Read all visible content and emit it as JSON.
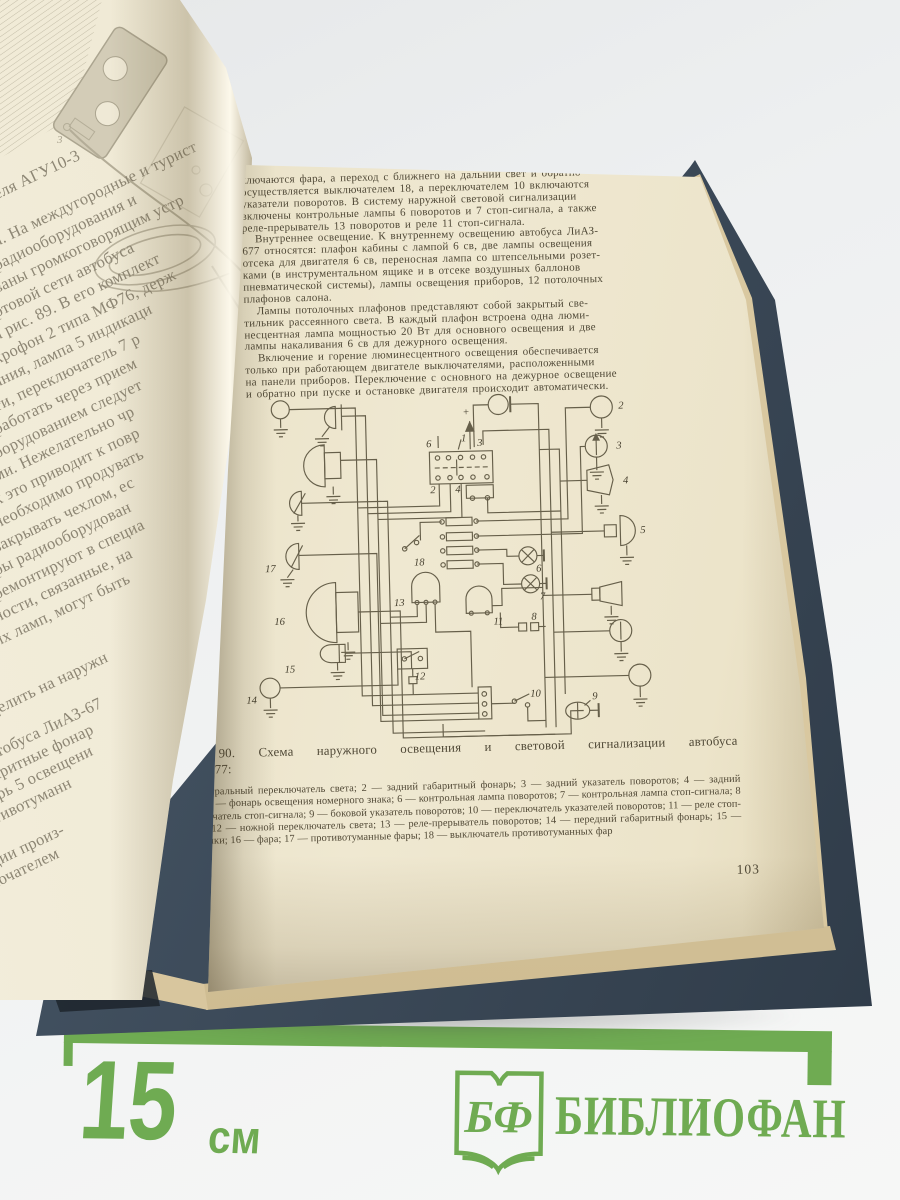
{
  "left_page": {
    "lines": [
      "еля АГУ10-3",
      "",
      "а. На междугородные и турист",
      "радиооборудования и",
      "ваны громкоговорящим устр",
      "ртовой сети автобуса",
      "а рис. 89. В его комплект",
      "крофон 2 типа МФ76, держ",
      "ания, лампа 5 индикаци",
      "ти, переключатель 7 р",
      "работать через прием",
      "борудованием следует",
      "ми. Нежелательно чр",
      "к это приводит к повр",
      "необходимо продувать",
      "закрывать чехлом, ес",
      "ры радиооборудован",
      "ремонтируют в специа",
      "ности, связанные, на",
      "их ламп, могут быть",
      "",
      "",
      "делить на наружн",
      "",
      "автобуса ЛиАЗ-67",
      "абаритные фонар",
      "онарь 5 освещени",
      "противотуманн",
      "",
      "лизации произ-",
      "ереключателем"
    ]
  },
  "right_page": {
    "body_lines": [
      {
        "text": "ключаются фара, а переход с ближнего на дальний свет и обратно",
        "indent": false
      },
      {
        "text": "осуществляется выключателем 18, а переключателем 10 включаются",
        "indent": false
      },
      {
        "text": "указатели поворотов. В систему наружной световой сигнализации",
        "indent": false
      },
      {
        "text": "включены контрольные лампы 6 поворотов и 7 стоп-сигнала, а также",
        "indent": false
      },
      {
        "text": "реле-прерыватель 13 поворотов и реле 11 стоп-сигнала.",
        "indent": false
      },
      {
        "text": "Внутреннее освещение. К внутреннему освещению автобуса ЛиАЗ-",
        "indent": true
      },
      {
        "text": "677 относятся: плафон кабины с лампой 6 св, две лампы освещения",
        "indent": false
      },
      {
        "text": "отсека для двигателя 6 св, переносная лампа со штепсельными розет-",
        "indent": false
      },
      {
        "text": "ками (в инструментальном ящике и в отсеке воздушных баллонов",
        "indent": false
      },
      {
        "text": "пневматической системы), лампы освещения приборов, 12 потолочных",
        "indent": false
      },
      {
        "text": "плафонов салона.",
        "indent": false
      },
      {
        "text": "Лампы потолочных плафонов представляют собой закрытый све-",
        "indent": true
      },
      {
        "text": "тильник рассеянного света. В каждый плафон встроена одна люми-",
        "indent": false
      },
      {
        "text": "несцентная лампа мощностью 20 Вт для основного освещения и две",
        "indent": false
      },
      {
        "text": "лампы накаливания 6 св для дежурного освещения.",
        "indent": false
      },
      {
        "text": "Включение и горение люминесцентного освещения обеспечивается",
        "indent": true
      },
      {
        "text": "только при работающем двигателе выключателями, расположенными",
        "indent": false
      },
      {
        "text": "на панели приборов. Переключение с основного на дежурное освещение",
        "indent": false
      },
      {
        "text": "и обратно при пуске и остановке двигателя происходит автоматически.",
        "indent": false
      }
    ],
    "figure": {
      "caption_line1": "Рис. 90. Схема наружного освещения и световой сигнализации автобуса",
      "caption_line2": "ЛиАЗ-677:",
      "legend": "1 — центральный переключатель света; 2 — задний габаритный фонарь; 3 — задний указатель поворотов; 4 — задний фонарь; 5 — фонарь освещения номерного знака; 6 — контрольная лампа поворотов; 7 — контрольная лампа стоп-сигнала; 8 — выключатель стоп-сигнала; 9 — боковой указатель поворотов; 10 — переключатель указателей поворотов; 11 — реле стоп-сигнала; 12 — ножной переключатель света; 13 — реле-прерыватель поворотов; 14 — передний габаритный фонарь; 15 — подфарники; 16 — фара; 17 — противотуманные фары; 18 — выключатель противотуманных фар",
      "diagram_labels": [
        {
          "t": "+",
          "x": 229,
          "y": 24
        },
        {
          "t": "1",
          "x": 227,
          "y": 50
        },
        {
          "t": "6",
          "x": 192,
          "y": 55
        },
        {
          "t": "3",
          "x": 243,
          "y": 55
        },
        {
          "t": "2",
          "x": 195,
          "y": 101
        },
        {
          "t": "4",
          "x": 220,
          "y": 101
        },
        {
          "t": "2",
          "x": 385,
          "y": 21
        },
        {
          "t": "3",
          "x": 382,
          "y": 61
        },
        {
          "t": "4",
          "x": 388,
          "y": 96
        },
        {
          "t": "5",
          "x": 404,
          "y": 146
        },
        {
          "t": "6",
          "x": 299,
          "y": 182
        },
        {
          "t": "7",
          "x": 302,
          "y": 210
        },
        {
          "t": "8",
          "x": 293,
          "y": 230
        },
        {
          "t": "9",
          "x": 352,
          "y": 311
        },
        {
          "t": "10",
          "x": 290,
          "y": 307
        },
        {
          "t": "11",
          "x": 255,
          "y": 234
        },
        {
          "t": "12",
          "x": 175,
          "y": 287
        },
        {
          "t": "13",
          "x": 156,
          "y": 213
        },
        {
          "t": "14",
          "x": 6,
          "y": 307
        },
        {
          "t": "15",
          "x": 45,
          "y": 277
        },
        {
          "t": "16",
          "x": 36,
          "y": 229
        },
        {
          "t": "17",
          "x": 28,
          "y": 176
        },
        {
          "t": "18",
          "x": 177,
          "y": 173
        }
      ]
    },
    "page_number": "103"
  },
  "ruler": {
    "length_label": "15",
    "unit": "см"
  },
  "logo": {
    "monogram": "БФ",
    "name": "БИБЛИОФАН"
  },
  "colors": {
    "ruler_green": "#6fab52",
    "cover_blue": "#3d4b5a",
    "page_cream": "#ece4cb",
    "ink": "#4f4836"
  }
}
